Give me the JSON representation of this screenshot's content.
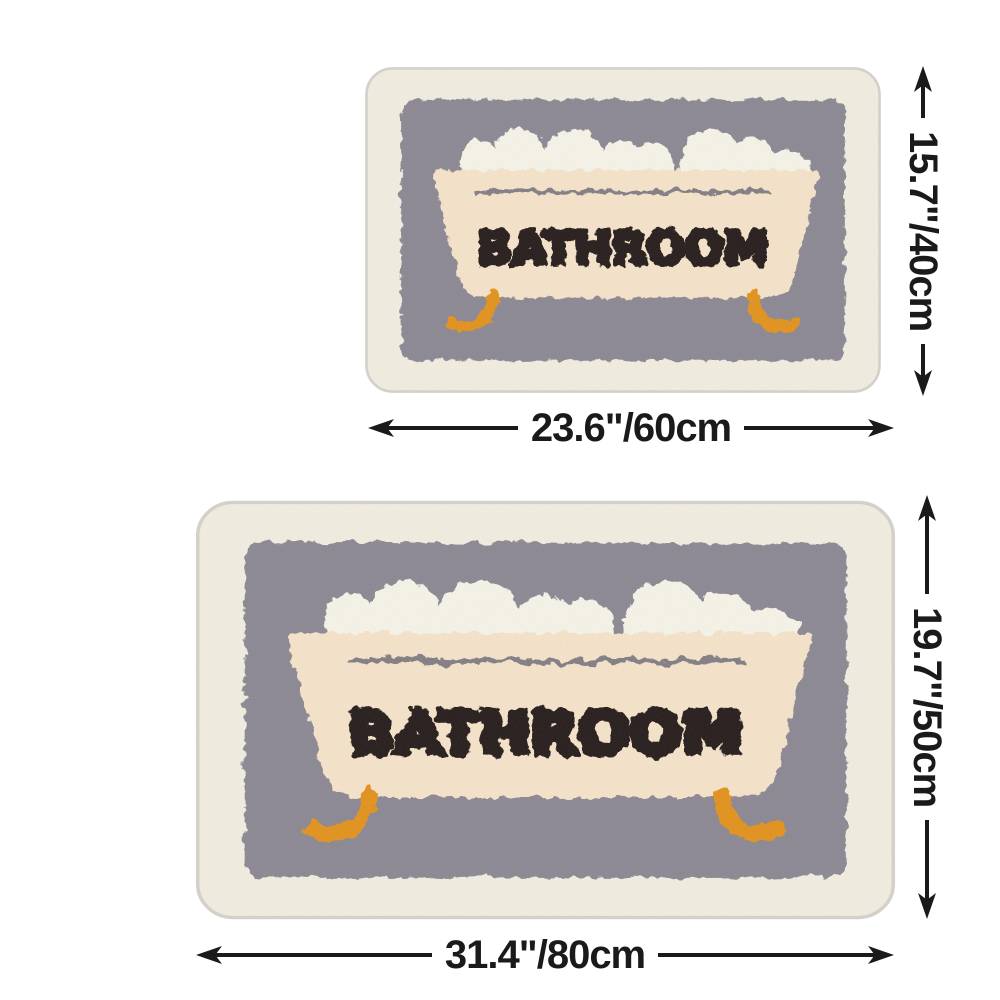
{
  "page": {
    "background": "#ffffff"
  },
  "product": {
    "design_label": "BATHROOM",
    "colors": {
      "mat_border": "#f1ede0",
      "mat_edge": "#d4d1cb",
      "panel": "#8b8893",
      "bubbles": "#f6f3e7",
      "tub": "#f5e3c9",
      "rim_line": "#75727c",
      "letters": "#271f1a",
      "feet": "#e2921f"
    },
    "sizes": {
      "small": {
        "width_label": "23.6\"/60cm",
        "height_label": "15.7\"/40cm"
      },
      "large": {
        "width_label": "31.4\"/80cm",
        "height_label": "19.7\"/50cm"
      }
    }
  },
  "annotation": {
    "color": "#1a1a1a"
  }
}
